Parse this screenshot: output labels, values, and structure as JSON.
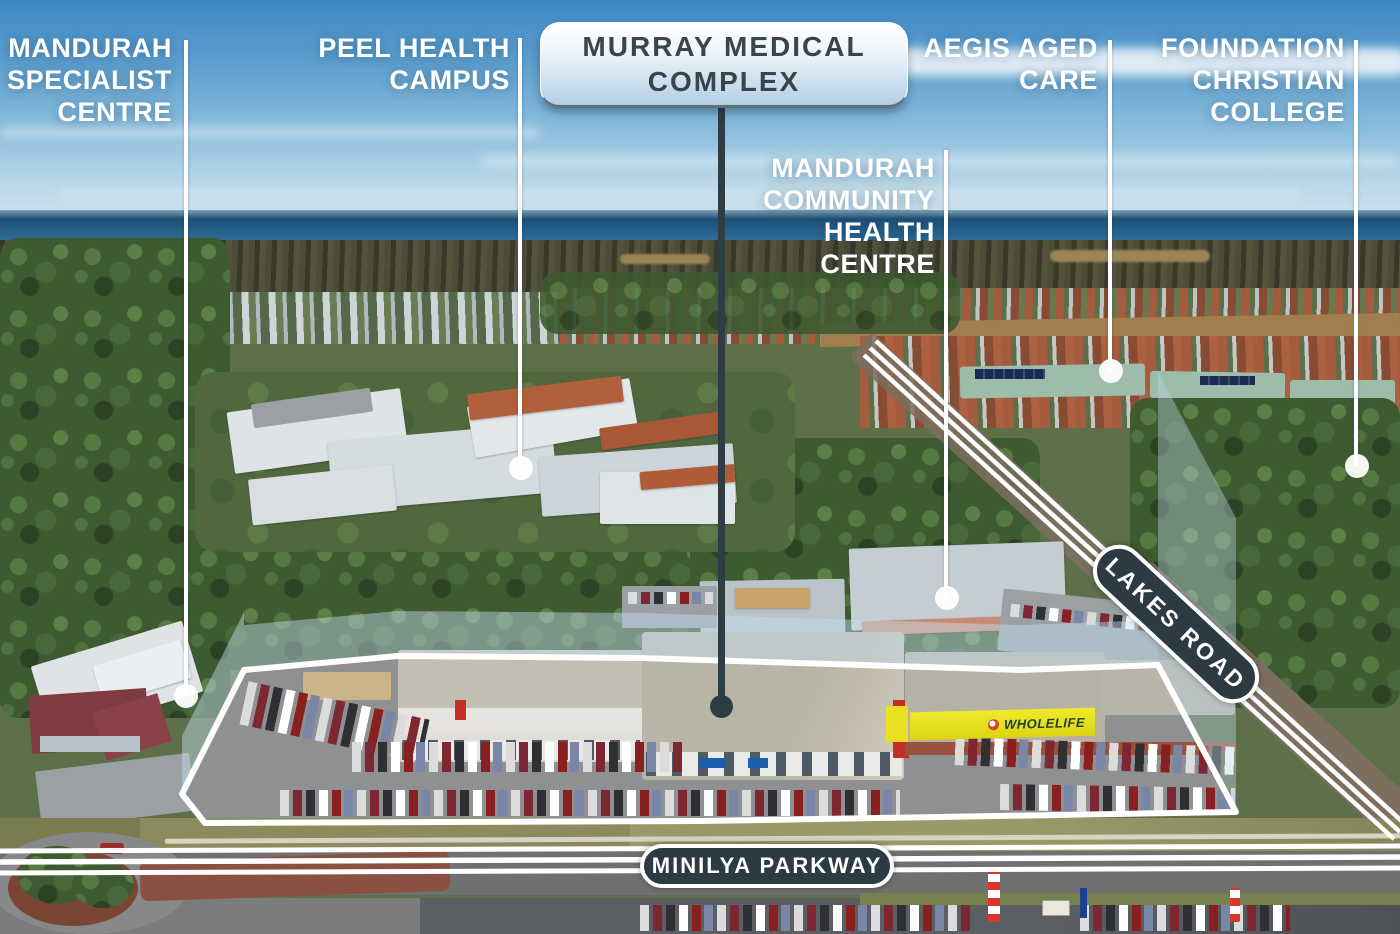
{
  "callouts": {
    "mandurah_specialist": {
      "line1": "MANDURAH",
      "line2": "SPECIALIST",
      "line3": "CENTRE"
    },
    "peel_health": {
      "line1": "PEEL HEALTH",
      "line2": "CAMPUS"
    },
    "murray_medical": {
      "line1": "MURRAY MEDICAL",
      "line2": "COMPLEX"
    },
    "aegis": {
      "line1": "AEGIS AGED",
      "line2": "CARE"
    },
    "foundation": {
      "line1": "FOUNDATION",
      "line2": "CHRISTIAN",
      "line3": "COLLEGE"
    },
    "community_health": {
      "line1": "MANDURAH",
      "line2": "COMMUNITY",
      "line3": "HEALTH",
      "line4": "CENTRE"
    }
  },
  "road_labels": {
    "lakes_road": "LAKES ROAD",
    "minilya_parkway": "MINILYA PARKWAY"
  },
  "building_signs": {
    "wholelife": "WHOLELIFE"
  },
  "colors": {
    "label_text": "#ffffff",
    "hero_pill_text": "#39444b",
    "hero_pill_gradient_top": "#ffffff",
    "hero_pill_gradient_bottom": "#b3cfe4",
    "road_pill_bg": "#2c3b43",
    "road_pill_border": "#ffffff",
    "boundary_line": "#ffffff",
    "boundary_fence": "rgba(198,224,241,0.45)",
    "dark_leader": "#2e3d44",
    "wholelife_sign_bg": "#e8e020"
  }
}
